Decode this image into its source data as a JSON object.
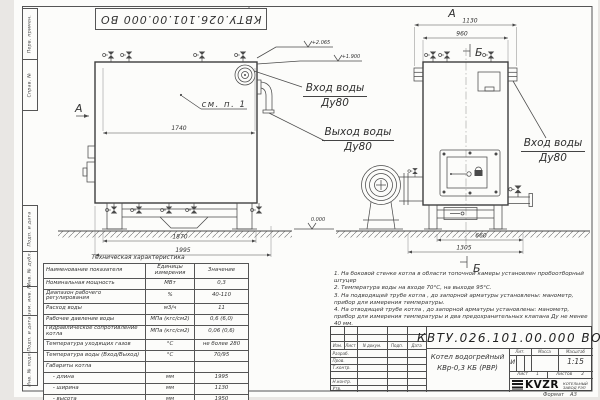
{
  "sheet": {
    "stamp_top": "КВТУ.026.101.00.000  ВО",
    "format_label": "Формат",
    "format_value": "А3"
  },
  "frame_strips": {
    "top": [
      "Перв. примен.",
      "Справ. №"
    ],
    "bottom": [
      "Подп. и дата",
      "Инв. № дубл.",
      "Взам. инв. №",
      "Подп. и дата",
      "Инв. № подл."
    ]
  },
  "drawing": {
    "view_front": {
      "marker_top": "В",
      "marker_side": "А",
      "see_note": "см. п. 1",
      "dim_top": "1740",
      "dim_base": "1870",
      "dim_total": "1995",
      "elev_top": "+2.065",
      "elev_mid": "+1.900"
    },
    "view_side": {
      "marker": "А",
      "section": "Б",
      "dim_width": "1130",
      "dim_body": "960",
      "dim_base": "660",
      "dim_full": "1305",
      "elev_zero": "0.000"
    },
    "labels": {
      "inlet_top_line1": "Вход воды",
      "inlet_top_line2": "Ду80",
      "outlet_line1": "Выход воды",
      "outlet_line2": "Ду80",
      "inlet_right_line1": "Вход воды",
      "inlet_right_line2": "Ду80"
    }
  },
  "table": {
    "title": "Техническая характеристика",
    "headers": [
      "Наименование показателя",
      "Единицы\nизмерения",
      "Значение"
    ],
    "rows": [
      [
        "Номинальная мощность",
        "МВт",
        "0,3"
      ],
      [
        "Диапазон рабочего регулирования",
        "%",
        "40-110"
      ],
      [
        "Расход воды",
        "м3/ч",
        "11"
      ],
      [
        "Рабочее давление воды",
        "МПа (кгс/см2)",
        "0,6 (6,0)"
      ],
      [
        "Гидравлическое сопротивление котла",
        "МПа (кгс/см2)",
        "0,06 (0,6)"
      ],
      [
        "Температура уходящих газов",
        "°С",
        "не более 280"
      ],
      [
        "Температура воды (Вход/Выход)",
        "°С",
        "70/95"
      ],
      [
        "Габариты котла",
        "",
        ""
      ],
      [
        "    - длина",
        "мм",
        "1995"
      ],
      [
        "    - ширина",
        "мм",
        "1130"
      ],
      [
        "    - высота",
        "мм",
        "1950"
      ]
    ]
  },
  "notes": {
    "items": [
      "1.  На боковой стенке котла в области топочной камеры установлен пробоотборный штуцер",
      "2.  Температура воды на входе  70°С,  на выходе  95°С.",
      "3.  На подводящей трубе котла , до запорной арматуры установлены:  манометр,  прибор для измерения температуры.",
      "4.  На отводящей трубе котла , до запорной арматуры установлены:  манометр,  прибор для измерения температуры и два предохранительных клапана  Ду не менее  40 мм.",
      "5.  Остальные технические требования по ОСТ  108.030.133-84."
    ]
  },
  "title_block": {
    "doc_number": "КВТУ.026.101.00.000  ВО",
    "product_line1": "Котел водогрейный",
    "product_line2": "КВр-0,3  КБ  (РВР)",
    "col_izm": "Изм.",
    "col_list": "Лист",
    "col_doc": "N докум.",
    "col_sign": "Подп.",
    "col_date": "Дата",
    "row_labels": [
      "Разраб.",
      "Пров.",
      "Т.контр.",
      "Н.контр.",
      "Утв."
    ],
    "lit_label": "Лит.",
    "mass_label": "Масса",
    "scale_label": "Масштаб",
    "lit_value": "И",
    "scale_value": "1:15",
    "sheet_label": "Лист",
    "sheet_num": "1",
    "sheets_label": "Листов",
    "sheets_num": "2",
    "logo_text": "KVZR",
    "company_line1": "КОТЕЛЬНЫЙ",
    "company_line2": "ЗАВОД РЭП"
  }
}
